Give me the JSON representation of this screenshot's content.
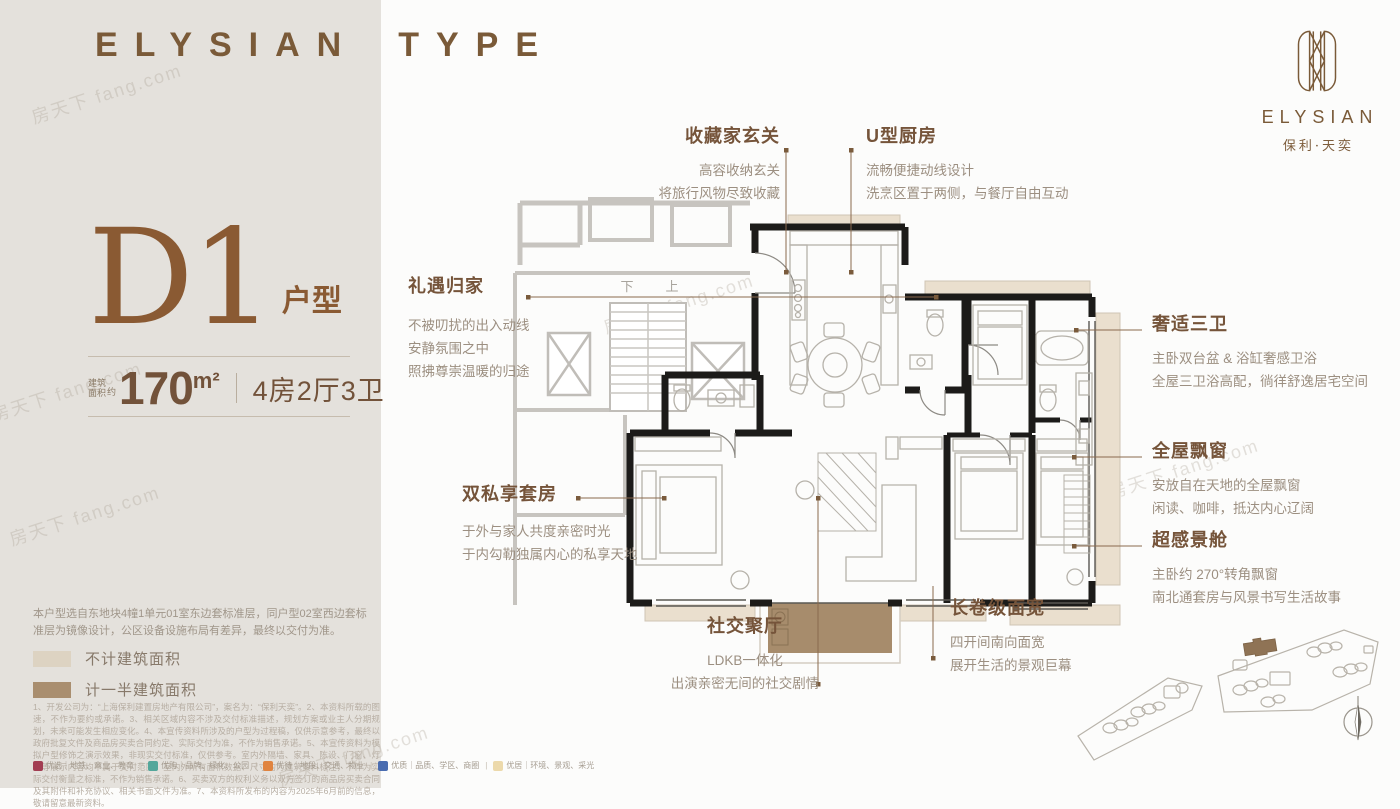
{
  "header": {
    "brand_word": "ELYSIAN",
    "type_word": "TYPE"
  },
  "logo": {
    "wordmark": "ELYSIAN",
    "cn_name": "保利·天奕"
  },
  "unit_panel": {
    "unit_code": "D1",
    "unit_type_label": "户型",
    "area_label_top": "建筑",
    "area_label_bottom": "面积",
    "area_approx": "约",
    "area_value": "170",
    "area_unit": "m²",
    "layout_text": "4房2厅3卫",
    "disclaimer": "本户型选自东地块4幢1单元01室东边套标准层，同户型02室西边套标准层为镜像设计，公区设备设施布局有差异，最终以交付为准。"
  },
  "legend": {
    "items": [
      {
        "label": "不计建筑面积",
        "color": "#ddd3c2"
      },
      {
        "label": "计一半建筑面积",
        "color": "#a98e6f"
      }
    ]
  },
  "callouts": {
    "entry": {
      "title": "收藏家玄关",
      "lines": [
        "高容收纳玄关",
        "将旅行风物尽致收藏"
      ]
    },
    "kitchen": {
      "title": "U型厨房",
      "lines": [
        "流畅便捷动线设计",
        "洗烹区置于两侧，与餐厅自由互动"
      ]
    },
    "homecoming": {
      "title": "礼遇归家",
      "lines": [
        "不被叨扰的出入动线",
        "安静氛围之中",
        "照拂尊崇温暖的归途"
      ]
    },
    "bath": {
      "title": "奢适三卫",
      "lines": [
        "主卧双台盆 & 浴缸奢感卫浴",
        "全屋三卫浴高配，徜徉舒逸居宅空间"
      ]
    },
    "baywindow": {
      "title": "全屋飘窗",
      "lines": [
        "安放自在天地的全屋飘窗",
        "闲读、咖啡，抵达内心辽阔"
      ]
    },
    "viewcabin": {
      "title": "超感景舱",
      "lines": [
        "主卧约 270°转角飘窗",
        "南北通套房与风景书写生活故事"
      ]
    },
    "suite": {
      "title": "双私享套房",
      "lines": [
        "于外与家人共度亲密时光",
        "于内勾勒独属内心的私享天地"
      ]
    },
    "living": {
      "title": "社交聚厅",
      "lines": [
        "LDKB一体化",
        "出演亲密无间的社交剧情"
      ]
    },
    "facade": {
      "title": "长卷级面宽",
      "lines": [
        "四开间南向面宽",
        "展开生活的景观巨幕"
      ]
    }
  },
  "floor_plan": {
    "stairs_down_label": "下",
    "stairs_up_label": "上"
  },
  "watermark": {
    "text": "房天下 fang.com"
  },
  "footer": {
    "fine_print": "1、开发公司为：“上海保利建置房地产有限公司”，案名为：“保利天奕”。2、本资料所载的图速，不作为要约或承诺。3、相关区域内容不涉及交付标准描述，规划方案或业主人分期规划，未来可能发生相应变化。4、本宣传资料所涉及的户型为过程稿，仅供示意参考，最终以政府批复文件及商品房买卖合同约定、实际交付为准，不作为销售承诺。5、本宣传资料为模拟户型修饰之演示效果，非现实交付标准，仅供参考。室内外隔墙、家具、陈设、门窗、灯具等展示内容均不属于交付范围，室内外所有面积数据、尺寸均为建筑资料标注，不作为实际交付衡量之标准，不作为销售承诺。6、买卖双方的权利义务以双方签订的商品房买卖合同及其附件和补充协议、相关书面文件为准。7、本资料所发布的内容为2025年6月前的信息，敬请留意最新资料。",
    "tags": [
      {
        "label": "优选",
        "sub": "地铁、商业、教育",
        "color": "#a23d52"
      },
      {
        "label": "优购",
        "sub": "品牌、绿化、公园",
        "color": "#53a79b"
      },
      {
        "label": "优待",
        "sub": "地段、交通、物业",
        "color": "#e08440"
      },
      {
        "label": "优质",
        "sub": "品质、学区、商圈",
        "color": "#4a6cb0"
      },
      {
        "label": "优居",
        "sub": "环境、景观、采光",
        "color": "#ecd9ab"
      }
    ]
  },
  "colors": {
    "panel_bg": "#e4e1dc",
    "brand_brown": "#7a5a38",
    "title_brown": "#75543a",
    "body_gray": "#9c8f81",
    "wall_black": "#1c1b19",
    "bay_window_fill": "#eadfce",
    "balcony_fill": "#a78c6c",
    "common_area_gray": "#c7c4bf",
    "site_highlight": "#8f7355"
  }
}
